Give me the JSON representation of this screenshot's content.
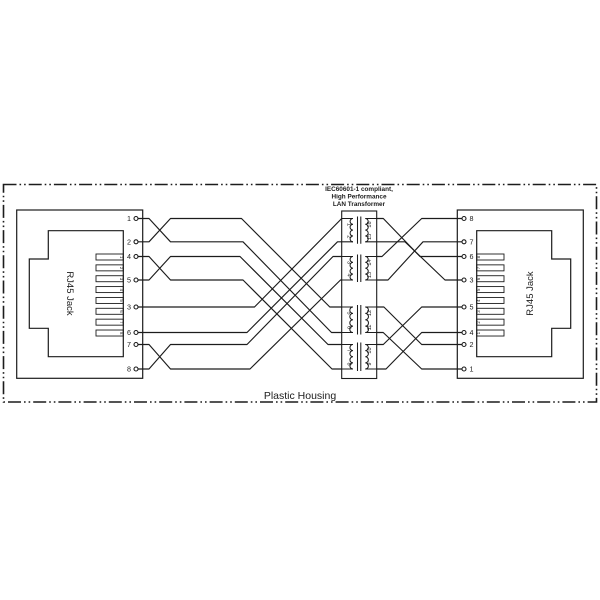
{
  "housing_label": "Plastic Housing",
  "transformer": {
    "title_lines": [
      "IEC60601-1 compliant,",
      "High Performance",
      "LAN Transformer"
    ],
    "left_pins": [
      "1",
      "2",
      "3",
      "4",
      "5",
      "6",
      "7",
      "8"
    ],
    "right_pins": [
      "16",
      "15",
      "14",
      "13",
      "12",
      "11",
      "10",
      "9"
    ]
  },
  "left_jack": {
    "label": "RJ45 Jack",
    "column_pins": [
      "1",
      "2",
      "4",
      "5",
      "3",
      "6",
      "7",
      "8"
    ],
    "contact_numbers": [
      "1",
      "2",
      "3",
      "4",
      "5",
      "6",
      "7",
      "8"
    ]
  },
  "right_jack": {
    "label": "RJ45 Jack",
    "column_pins": [
      "8",
      "7",
      "6",
      "3",
      "5",
      "4",
      "2",
      "1"
    ],
    "contact_numbers": [
      "8",
      "7",
      "6",
      "5",
      "4",
      "3",
      "2",
      "1"
    ]
  },
  "connections": {
    "left_jack_to_transformer": [
      {
        "jack_pin": "1",
        "transformer_pin": "6"
      },
      {
        "jack_pin": "2",
        "transformer_pin": "5"
      },
      {
        "jack_pin": "3",
        "transformer_pin": "1"
      },
      {
        "jack_pin": "4",
        "transformer_pin": "8"
      },
      {
        "jack_pin": "5",
        "transformer_pin": "7"
      },
      {
        "jack_pin": "6",
        "transformer_pin": "2"
      },
      {
        "jack_pin": "7",
        "transformer_pin": "4"
      },
      {
        "jack_pin": "8",
        "transformer_pin": "3"
      }
    ],
    "right_jack_to_transformer": [
      {
        "jack_pin": "8",
        "transformer_pin": "14"
      },
      {
        "jack_pin": "7",
        "transformer_pin": "13"
      },
      {
        "jack_pin": "6",
        "transformer_pin": "16"
      },
      {
        "jack_pin": "3",
        "transformer_pin": "15"
      },
      {
        "jack_pin": "5",
        "transformer_pin": "10"
      },
      {
        "jack_pin": "4",
        "transformer_pin": "9"
      },
      {
        "jack_pin": "2",
        "transformer_pin": "12"
      },
      {
        "jack_pin": "1",
        "transformer_pin": "11"
      }
    ]
  },
  "colors": {
    "line": "#1c1c1c",
    "background": "#ffffff"
  }
}
